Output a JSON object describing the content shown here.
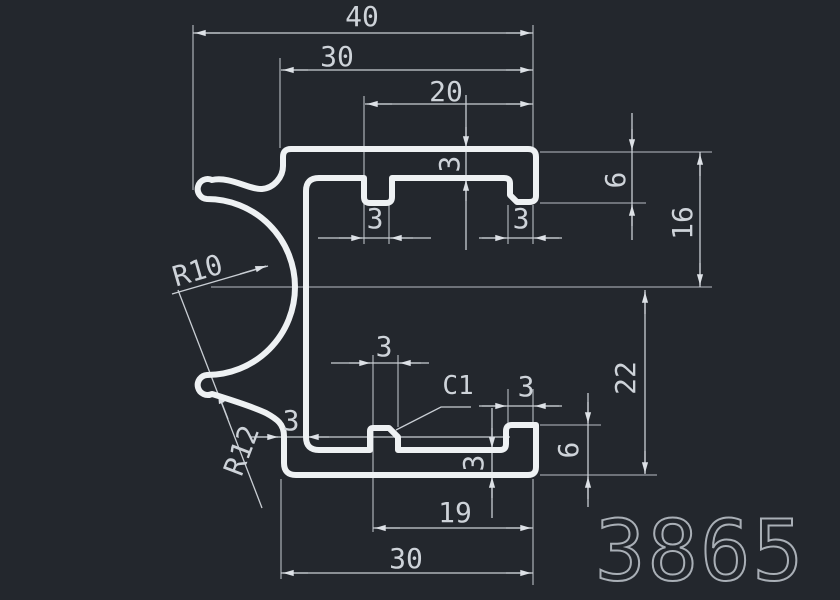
{
  "drawing": {
    "type": "aluminium-profile-cross-section",
    "part_number": "3865",
    "colors": {
      "background": "#23272d",
      "profile_line": "#eef1f3",
      "dimension_line": "#c9ced4",
      "dimension_text": "#ced3d9",
      "part_number_text": "#a9afb6"
    },
    "dimensions": {
      "overall_width": "40",
      "top_width": "30",
      "slot_width": "20",
      "top_flange_thickness": "3",
      "top_notch_width": "3",
      "top_step_width": "3",
      "top_lip_depth": "6",
      "upper_height": "16",
      "lower_height": "22",
      "bottom_lip_depth": "6",
      "chamfer": "C1",
      "bottom_step_width": "3",
      "bump_width": "3",
      "wall_thickness": "3",
      "bottom_flange_thickness": "3",
      "bottom_inner_width": "19",
      "bottom_width": "30",
      "clip_inner_radius": "R10",
      "clip_outer_radius": "R12"
    }
  }
}
